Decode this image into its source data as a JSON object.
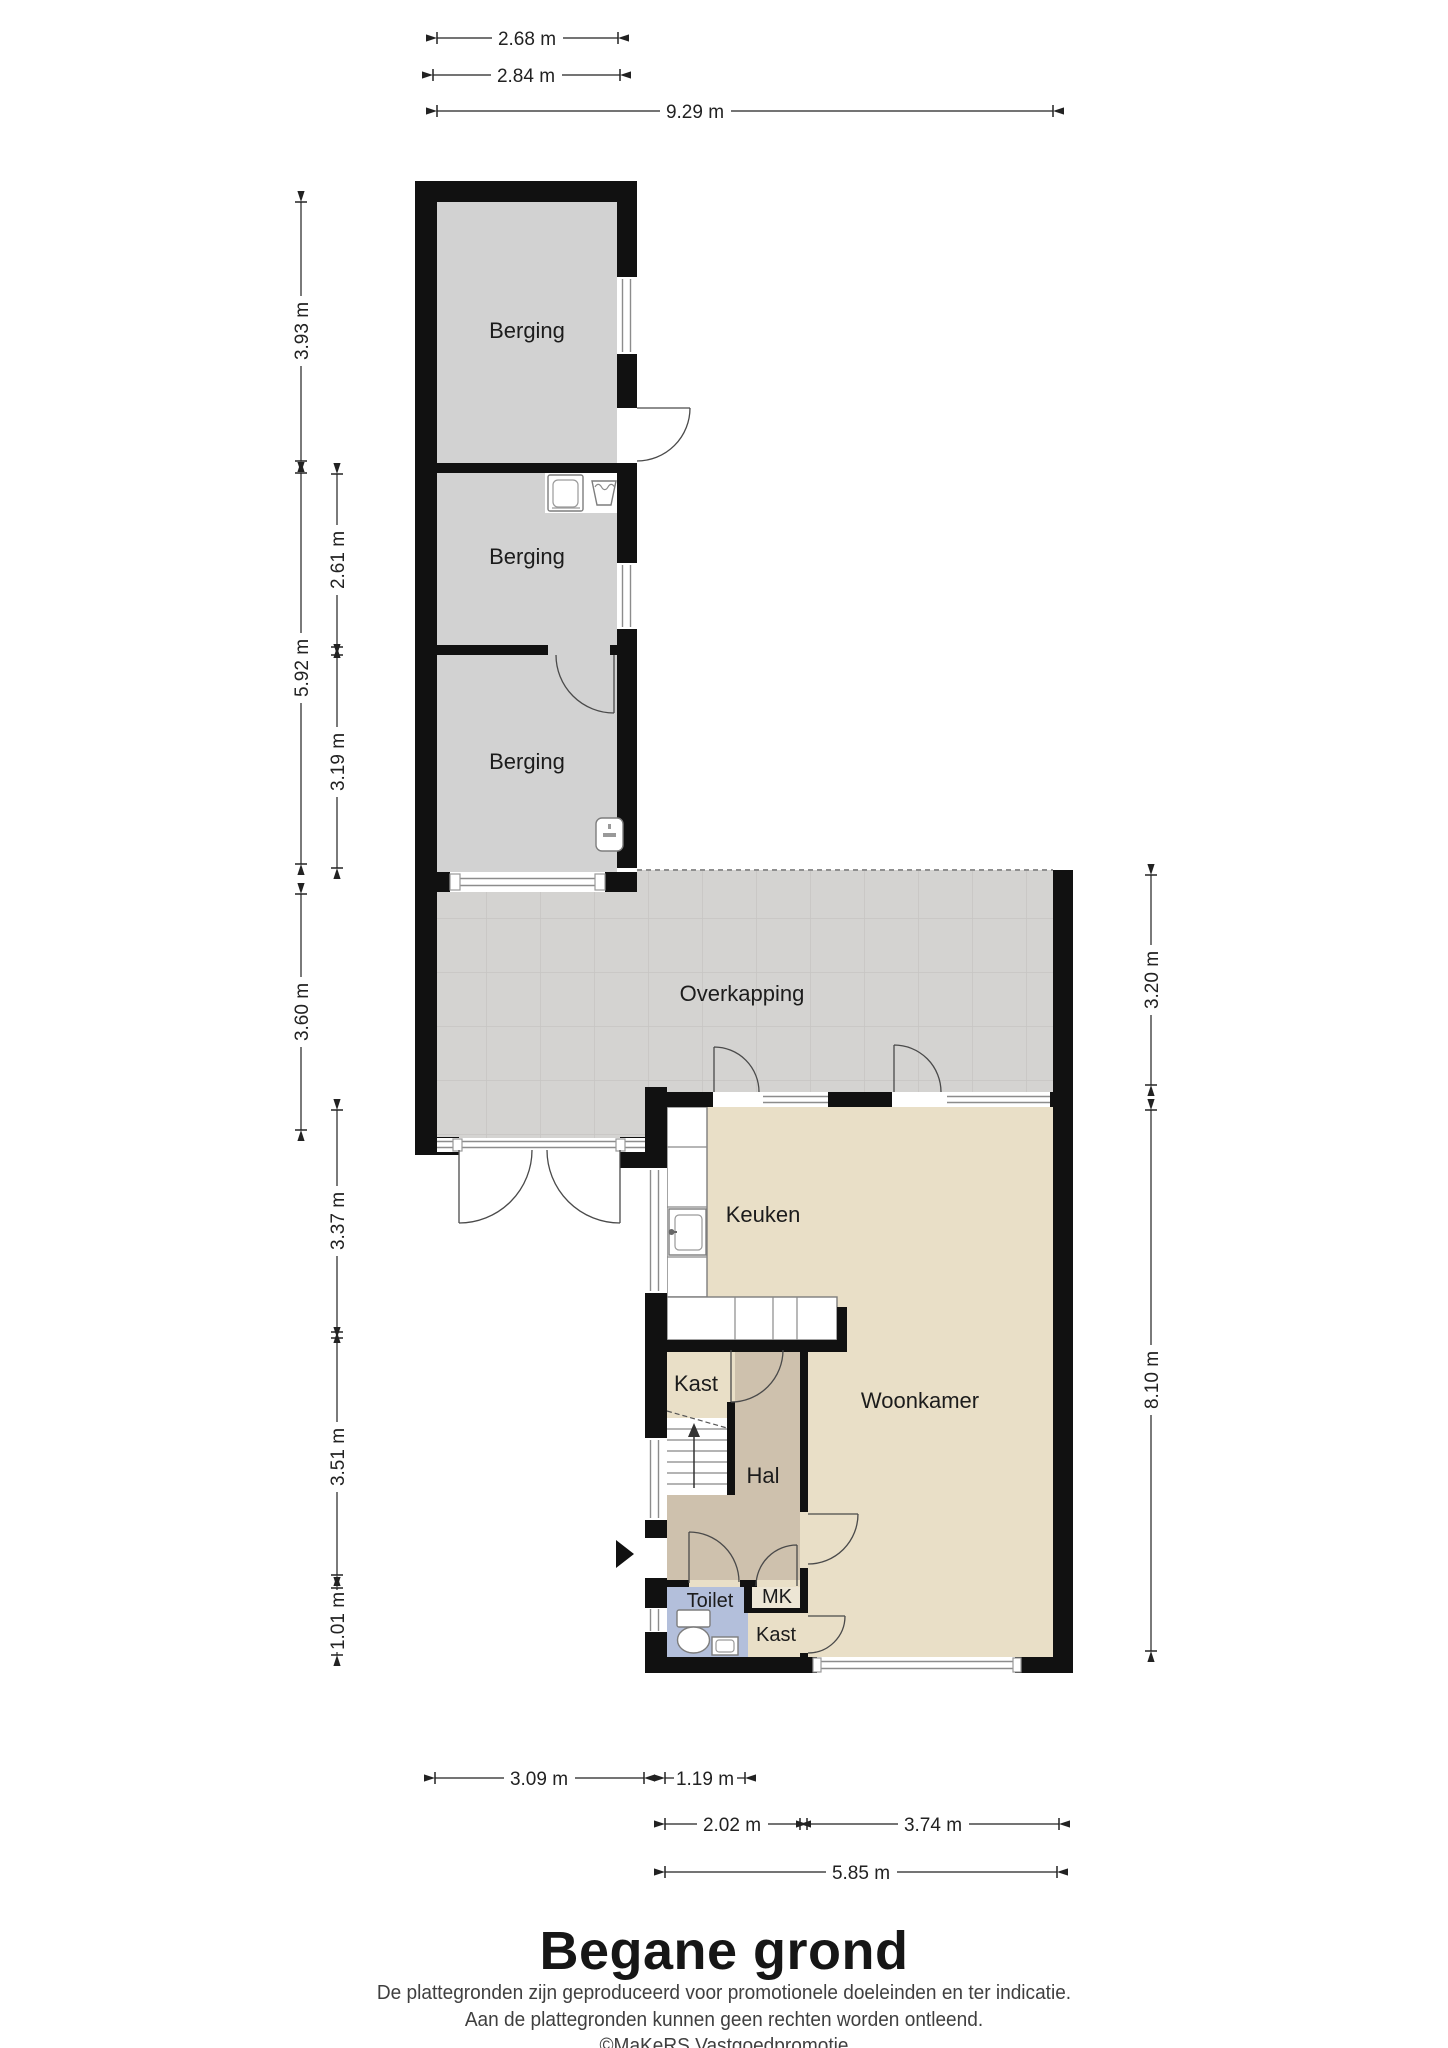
{
  "plan": {
    "title": "Begane grond",
    "rooms": {
      "berging_1": "Berging",
      "berging_2": "Berging",
      "berging_3": "Berging",
      "overkapping": "Overkapping",
      "keuken": "Keuken",
      "woonkamer": "Woonkamer",
      "kast_boven": "Kast",
      "hal": "Hal",
      "toilet": "Toilet",
      "mk": "MK",
      "kast_onder": "Kast"
    },
    "dims": {
      "top_inner": "2.68 m",
      "top_outer": "2.84 m",
      "top_total": "9.29 m",
      "left_berging1": "3.93 m",
      "left_berging23": "5.92 m",
      "left_overkapping": "3.60 m",
      "mid_berging2": "2.61 m",
      "mid_berging3": "3.19 m",
      "mid_keuken": "3.37 m",
      "mid_hal": "3.51 m",
      "mid_toilet": "1.01 m",
      "right_overkapping": "3.20 m",
      "right_woonkamer": "8.10 m",
      "bottom_berging": "3.09 m",
      "bottom_toilet": "1.19 m",
      "bottom_hal": "2.02 m",
      "bottom_woonkamer": "3.74 m",
      "bottom_total": "5.85 m"
    },
    "footer": {
      "disclaimer_1": "De plattegronden zijn geproduceerd voor promotionele doeleinden en ter indicatie.",
      "disclaimer_2": "Aan de plattegronden kunnen geen rechten worden ontleend.",
      "credit": "©MaKeRS Vastgoedpromotie"
    },
    "colors": {
      "wall": "#111111",
      "berging_floor": "#d2d2d2",
      "overkapping_floor": "#d4d3d1",
      "living_floor": "#e9dfc7",
      "hal_floor": "#cec1ad",
      "toilet_floor": "#b3bfdb",
      "mk_floor": "#ede6d5",
      "stairs_floor": "#ffffff"
    },
    "icons": {
      "washing_machine": "washing-machine-icon",
      "laundry_tub": "laundry-tub-icon",
      "boiler": "boiler-icon",
      "kitchen_sink": "sink-icon",
      "toilet_bowl": "toilet-icon",
      "hand_basin": "hand-basin-icon",
      "stairs": "stairs-icon",
      "entrance_arrow": "entrance-arrow-icon"
    }
  }
}
